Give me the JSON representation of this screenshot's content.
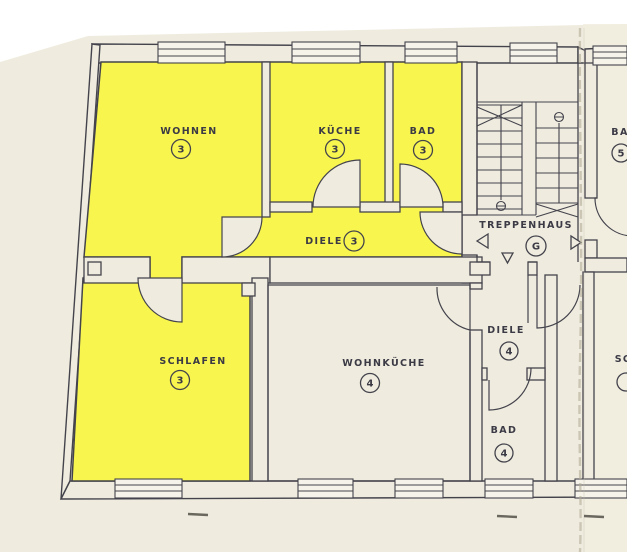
{
  "plan": {
    "kind": "floor-plan",
    "highlight_meaning": "apartment 3 highlighted",
    "stairwell_arrows": [
      "left",
      "down",
      "right"
    ]
  },
  "colors": {
    "paper": "#efecdf",
    "paper_right": "#f1eee1",
    "highlight_yellow": "#f8f64e",
    "line": "#44434c",
    "window_fill": "#f6f4ea",
    "fold": "#b3ab98"
  },
  "rooms": [
    {
      "id": "wohnen",
      "label": "WOHNEN",
      "number": "3",
      "highlighted": true
    },
    {
      "id": "kueche",
      "label": "KÜCHE",
      "number": "3",
      "highlighted": true
    },
    {
      "id": "bad-3",
      "label": "BAD",
      "number": "3",
      "highlighted": true
    },
    {
      "id": "diele-3",
      "label": "DIELE",
      "number": "3",
      "highlighted": true
    },
    {
      "id": "schlafen-3",
      "label": "SCHLAFEN",
      "number": "3",
      "highlighted": true
    },
    {
      "id": "treppenhaus",
      "label": "TREPPENHAUS",
      "number": "G",
      "highlighted": false
    },
    {
      "id": "wohnkueche",
      "label": "WOHNKÜCHE",
      "number": "4",
      "highlighted": false
    },
    {
      "id": "diele-4",
      "label": "DIELE",
      "number": "4",
      "highlighted": false
    },
    {
      "id": "bad-4",
      "label": "BAD",
      "number": "4",
      "highlighted": false
    },
    {
      "id": "bad-5",
      "label": "BA",
      "number": "5",
      "highlighted": false
    },
    {
      "id": "schlafen-5",
      "label": "SC",
      "number": "",
      "highlighted": false
    }
  ]
}
